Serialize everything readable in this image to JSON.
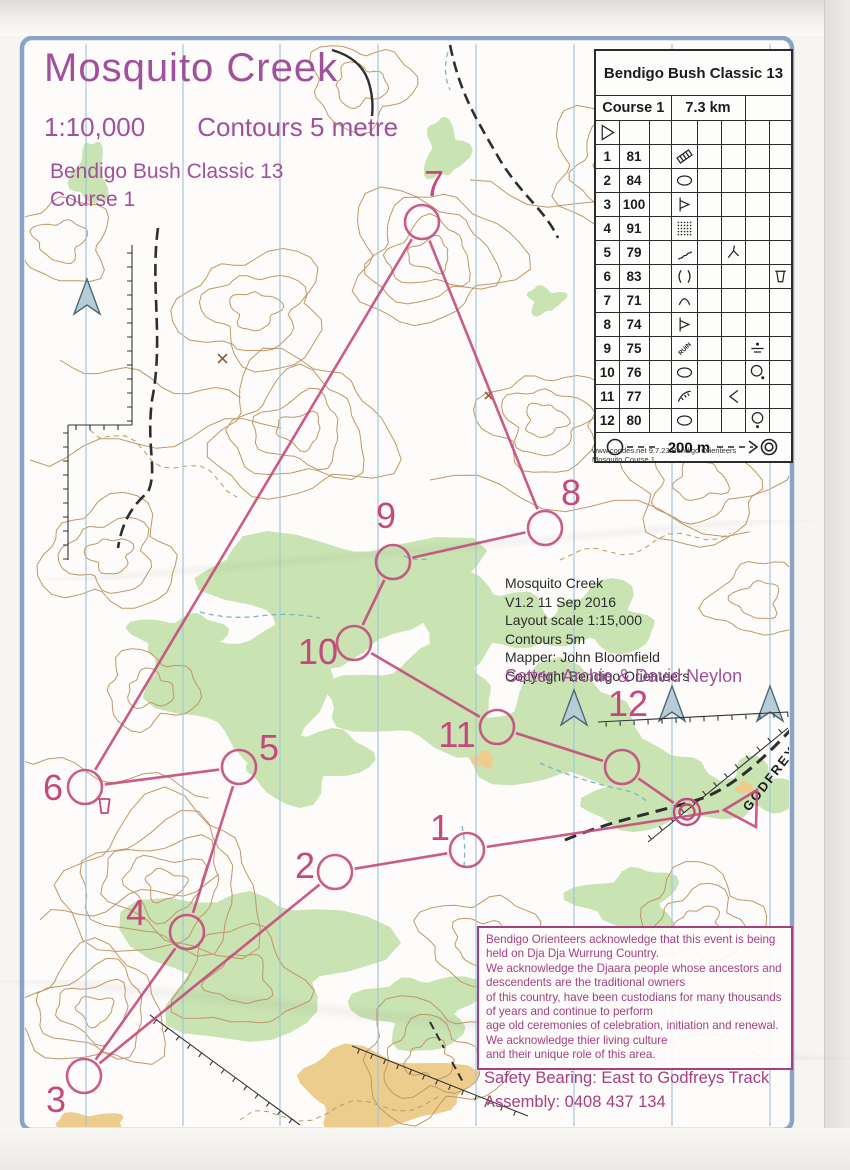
{
  "title_block": {
    "title": "Mosquito Creek",
    "scale": "1:10,000",
    "contours": "Contours 5 metre",
    "event": "Bendigo Bush Classic 13",
    "course": "Course 1"
  },
  "info_block": {
    "lines": [
      "Mosquito Creek",
      "V1.2 11 Sep 2016",
      "Layout scale 1:15,000",
      "Contours 5m",
      "Mapper: John Bloomfield",
      "Copyright Bendigo Orienteers"
    ]
  },
  "setter": "Setter: Archie & David Neylon",
  "acknowledgement": {
    "lines": [
      "Bendigo Orienteers acknowledge that this event is being",
      "held on Dja Dja Wurrung Country.",
      "We acknowledge the Djaara people whose ancestors and",
      "descendents are the traditional owners",
      "of this country, have been custodians for many thousands",
      "of years and continue to perform",
      "age old ceremonies of celebration, initiation and renewal.",
      "We acknowledge thier living culture",
      "and their unique role of this area."
    ]
  },
  "safety": {
    "lines": [
      "Safety Bearing: East to Godfreys Track",
      "Assembly: 0408 437 134"
    ]
  },
  "track_label": "GODFREYS",
  "control_card": {
    "title": "Bendigo Bush Classic 13",
    "course": "Course 1",
    "length": "7.3 km",
    "start_symbol": "start",
    "rows": [
      {
        "num": "1",
        "code": "81",
        "d": "crossing",
        "f": "",
        "g": "",
        "h": ""
      },
      {
        "num": "2",
        "code": "84",
        "d": "depression",
        "f": "",
        "g": "",
        "h": ""
      },
      {
        "num": "3",
        "code": "100",
        "d": "spur",
        "f": "",
        "g": "",
        "h": ""
      },
      {
        "num": "4",
        "code": "91",
        "d": "dots",
        "f": "",
        "g": "",
        "h": ""
      },
      {
        "num": "5",
        "code": "79",
        "d": "gully",
        "f": "junctiony",
        "g": "",
        "h": ""
      },
      {
        "num": "6",
        "code": "83",
        "d": "saddle",
        "f": "",
        "g": "",
        "h": "cup"
      },
      {
        "num": "7",
        "code": "71",
        "d": "hill",
        "f": "",
        "g": "",
        "h": ""
      },
      {
        "num": "8",
        "code": "74",
        "d": "spur",
        "f": "",
        "g": "",
        "h": ""
      },
      {
        "num": "9",
        "code": "75",
        "d": "ruin",
        "f": "",
        "g": "dotline",
        "h": ""
      },
      {
        "num": "10",
        "code": "76",
        "d": "depression",
        "f": "",
        "g": "circledotse",
        "h": ""
      },
      {
        "num": "11",
        "code": "77",
        "d": "earthbank",
        "f": "lessthan",
        "g": "",
        "h": ""
      },
      {
        "num": "12",
        "code": "80",
        "d": "depression",
        "f": "",
        "g": "circledots",
        "h": ""
      }
    ],
    "footer_distance": "200 m",
    "credit_line1": "www.condes.net 9.7.23 Bendigo Orienteers",
    "credit_line2": "Mosquito Course 1"
  },
  "course": {
    "color": "#c44a7b",
    "start": {
      "points": [
        [
          724,
          810
        ],
        [
          757,
          790
        ],
        [
          756,
          827
        ]
      ]
    },
    "finish": {
      "x": 687,
      "y": 812
    },
    "water_cup": {
      "x": 104,
      "y": 806
    },
    "controls": [
      {
        "label": "1",
        "x": 467,
        "y": 850,
        "lx": 440,
        "ly": 840
      },
      {
        "label": "2",
        "x": 335,
        "y": 872,
        "lx": 305,
        "ly": 878
      },
      {
        "label": "3",
        "x": 84,
        "y": 1076,
        "lx": 56,
        "ly": 1112
      },
      {
        "label": "4",
        "x": 187,
        "y": 932,
        "lx": 136,
        "ly": 925
      },
      {
        "label": "5",
        "x": 239,
        "y": 767,
        "lx": 269,
        "ly": 760
      },
      {
        "label": "6",
        "x": 85,
        "y": 787,
        "lx": 53,
        "ly": 800
      },
      {
        "label": "7",
        "x": 422,
        "y": 222,
        "lx": 434,
        "ly": 196
      },
      {
        "label": "8",
        "x": 545,
        "y": 528,
        "lx": 571,
        "ly": 505
      },
      {
        "label": "9",
        "x": 393,
        "y": 562,
        "lx": 386,
        "ly": 528
      },
      {
        "label": "10",
        "x": 354,
        "y": 643,
        "lx": 318,
        "ly": 664
      },
      {
        "label": "11",
        "x": 497,
        "y": 727,
        "lx": 457,
        "ly": 747
      },
      {
        "label": "12",
        "x": 622,
        "y": 767,
        "lx": 628,
        "ly": 716
      }
    ]
  },
  "colors": {
    "course": "#c44a7b",
    "title_purple": "#a1519b",
    "ack_purple": "#a43f80",
    "vegetation_green": "#c9e3b2",
    "open_orange": "#edcd8d",
    "contour_brown": "#c09766",
    "north_blue": "#9fc6da",
    "border_blue": "#8aa3c6"
  }
}
